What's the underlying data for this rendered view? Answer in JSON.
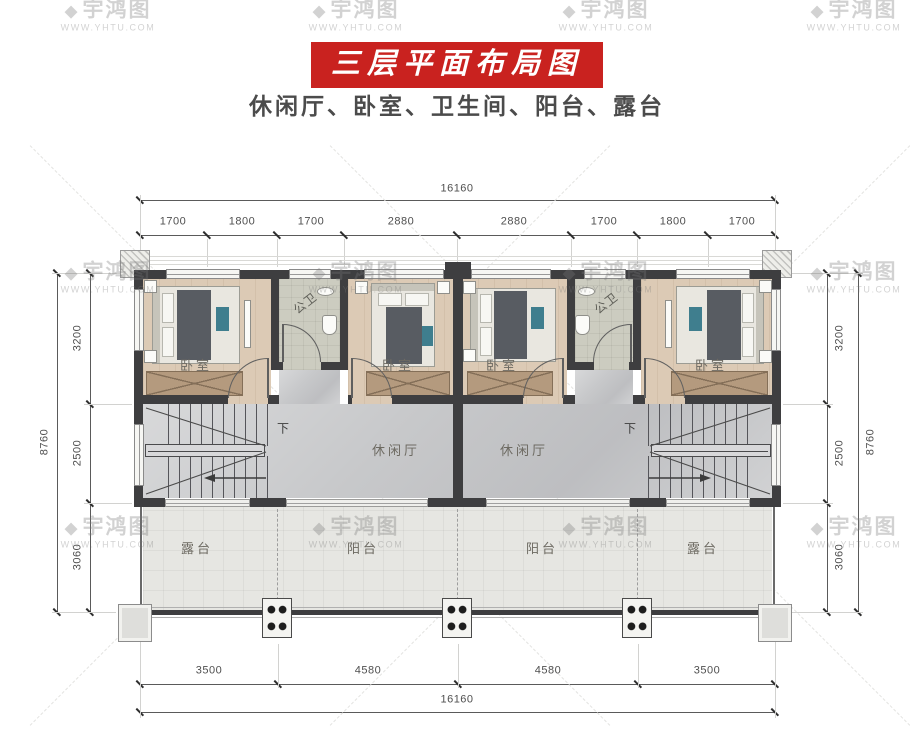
{
  "title": {
    "banner": "三层平面布局图",
    "subtitle": "休闲厅、卧室、卫生间、阳台、露台"
  },
  "watermark": {
    "brand": "宇鸿图",
    "url": "WWW.YHTU.COM",
    "logo_icon": "diamond-badge"
  },
  "plan": {
    "rooms": {
      "bedroom": "卧室",
      "bathroom": "公卫",
      "leisure": "休闲厅",
      "balcony": "阳台",
      "terrace": "露台",
      "stairs_down": "下"
    },
    "dimensions": {
      "top": {
        "total": "16160",
        "segments": [
          "1700",
          "1800",
          "1700",
          "2880",
          "2880",
          "1700",
          "1800",
          "1700"
        ]
      },
      "bottom": {
        "total": "16160",
        "segments": [
          "3500",
          "4580",
          "4580",
          "3500"
        ]
      },
      "left": {
        "total": "8760",
        "segments": [
          "3200",
          "2500",
          "3060"
        ]
      },
      "right": {
        "total": "8760",
        "segments": [
          "3200",
          "2500",
          "3060"
        ]
      }
    },
    "colors": {
      "banner_red": "#c9221f",
      "wall": "#3e3e40",
      "wood_floor": "#dccab5",
      "marble_floor": "#c7c8ca",
      "bath_floor": "#ccccc0",
      "terrace_floor": "#e6e6e2"
    }
  }
}
